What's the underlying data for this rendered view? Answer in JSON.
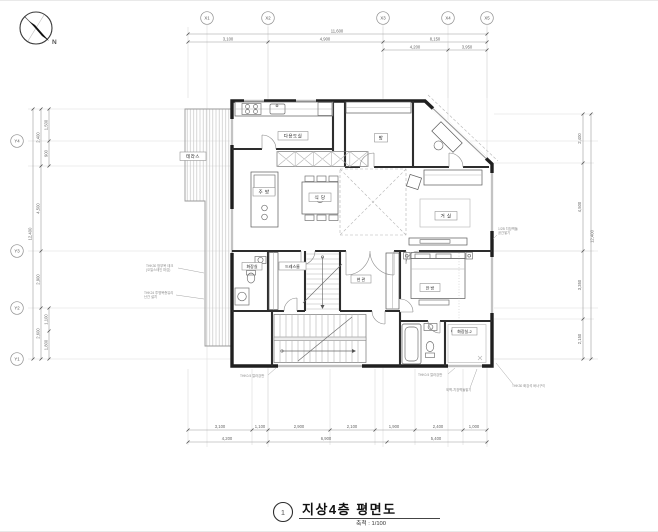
{
  "title_block": {
    "sheet_no": "1",
    "title": "지상4층 평면도",
    "scale": "축척 : 1/100"
  },
  "compass": {
    "north": "N"
  },
  "grid": {
    "x_labels": [
      "X1",
      "X2",
      "X3",
      "X4",
      "X5"
    ],
    "y_labels": [
      "Y4",
      "Y3",
      "Y2",
      "Y1"
    ]
  },
  "dimensions": {
    "top_total": "11,600",
    "top_row2": [
      "3,100",
      "4,900",
      "8,150"
    ],
    "top_row3": [
      "4,200",
      "3,950"
    ],
    "bottom_row1": [
      "3,100",
      "1,100",
      "2,900",
      "2,100",
      "1,900",
      "2,400",
      "1,000"
    ],
    "bottom_row2": [
      "4,200",
      "6,900",
      "5,400"
    ],
    "left_total": "12,400",
    "left_segs": [
      "2,400",
      "4,500",
      "2,900",
      "2,600"
    ],
    "left_subs": [
      "1,500",
      "900",
      "1,100",
      "1,800"
    ],
    "right_total": "12,400",
    "right_segs": [
      "2,400",
      "4,500",
      "3,350",
      "2,150"
    ]
  },
  "rooms": {
    "terrace": "테라스",
    "utility": "다용도실",
    "kitchen": "주 방",
    "dining": "식 당",
    "room": "방",
    "living": "거 실",
    "dress_room": "드레스룸",
    "entry": "현 관",
    "bathroom": "화장실",
    "master_bedroom": "안 방",
    "bathroom2": "화장실-2"
  },
  "annotations": {
    "deck1": "THK30 방부목 데크",
    "deck2": "(오일스테인 마감)",
    "rail1": "THK24 투명복층유리",
    "rail2": "난간 설치",
    "panel_left": "THK0.5 칼라강판",
    "panel_right": "THK0.5 칼라강판",
    "brick_bottom": "외벽-치장벽돌쌓기",
    "stone_bottom": "THK30 화강석 버너구이",
    "brick_right1": "1/2B 치장벽돌",
    "brick_right2": "공간쌓기"
  },
  "colors": {
    "wall": "#1f1f1f",
    "line": "#666666",
    "grid": "#dedede",
    "accent": "#333333"
  }
}
